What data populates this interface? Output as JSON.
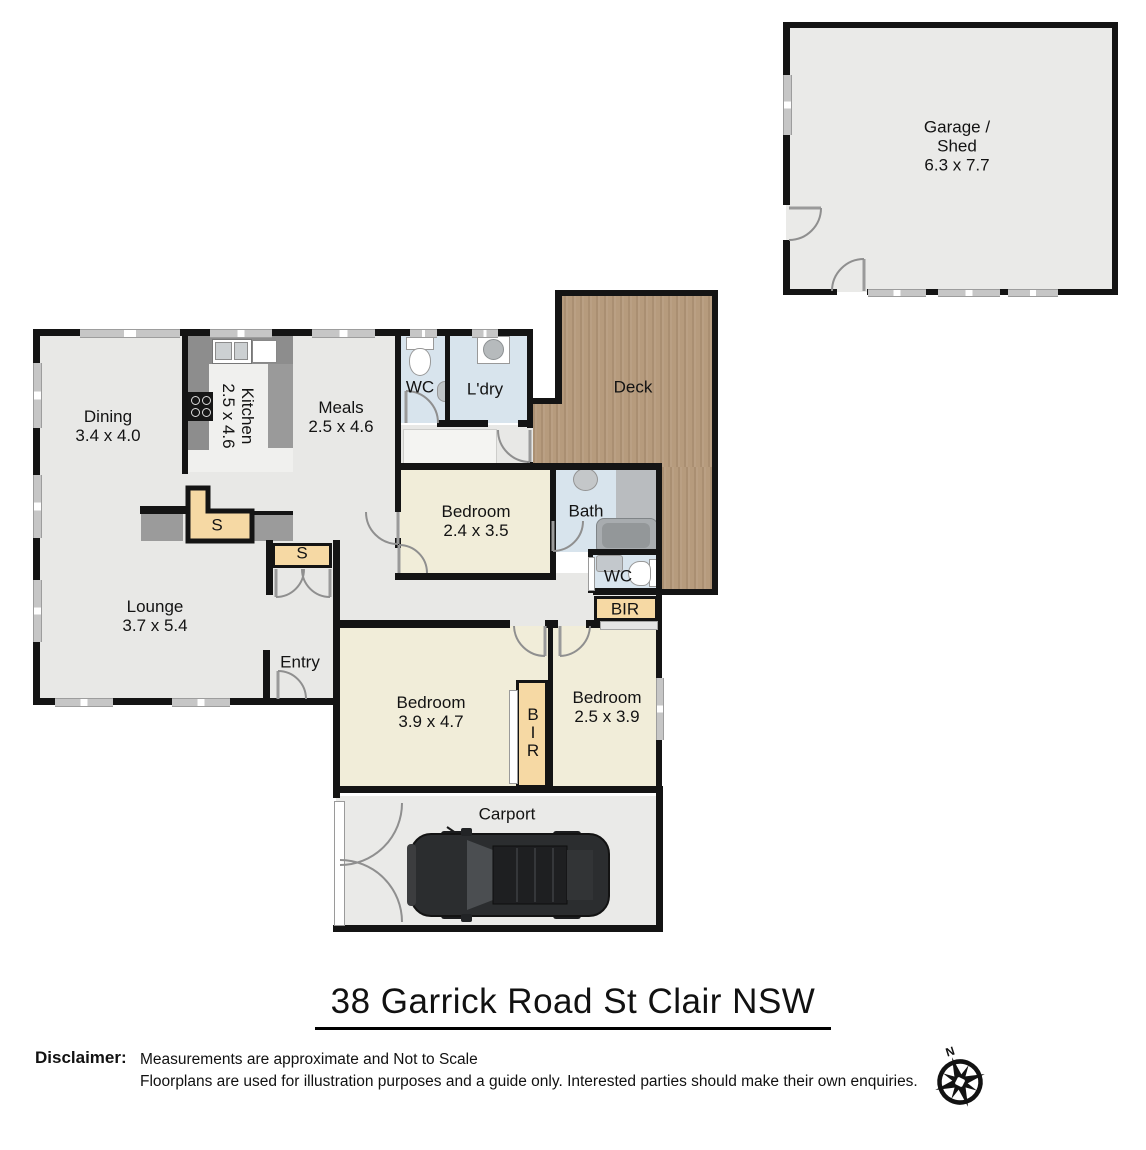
{
  "title": "38 Garrick Road St Clair  NSW",
  "rooms": {
    "garage": {
      "name": "Garage /",
      "name2": "Shed",
      "dims": "6.3 x 7.7"
    },
    "dining": {
      "name": "Dining",
      "dims": "3.4 x 4.0"
    },
    "kitchen": {
      "name": "Kitchen",
      "dims": "2.5 x 4.6"
    },
    "meals": {
      "name": "Meals",
      "dims": "2.5 x 4.6"
    },
    "wc_top": {
      "name": "WC"
    },
    "laundry": {
      "name": "L'dry"
    },
    "deck": {
      "name": "Deck"
    },
    "bed_mid": {
      "name": "Bedroom",
      "dims": "2.4 x 3.5"
    },
    "bath": {
      "name": "Bath"
    },
    "wc_rear": {
      "name": "WC"
    },
    "bir_rear": {
      "name": "BIR"
    },
    "storage_a": {
      "name": "S"
    },
    "storage_b": {
      "name": "S"
    },
    "lounge": {
      "name": "Lounge",
      "dims": "3.7 x 5.4"
    },
    "entry": {
      "name": "Entry"
    },
    "bed_main": {
      "name": "Bedroom",
      "dims": "3.9 x 4.7"
    },
    "bir_mid": {
      "name": "BIR"
    },
    "bed_rear": {
      "name": "Bedroom",
      "dims": "2.5 x 3.9"
    },
    "carport": {
      "name": "Carport"
    }
  },
  "disclaimer": {
    "label": "Disclaimer:",
    "line1": "Measurements are approximate and Not to Scale",
    "line2": "Floorplans are used for illustration purposes and a guide only.   Interested parties should make their own enquiries."
  },
  "compass": {
    "north": "N"
  },
  "colors": {
    "wall": "#141414",
    "floor_gray": "#e8e8e6",
    "floor_cream": "#f1edd9",
    "floor_wet": "#d8e4ed",
    "deck_wood": "#b69b7d",
    "storage_tan": "#f6d9a4",
    "window_gray": "#c6c6c6",
    "counter_gray": "#8d8d8d"
  }
}
